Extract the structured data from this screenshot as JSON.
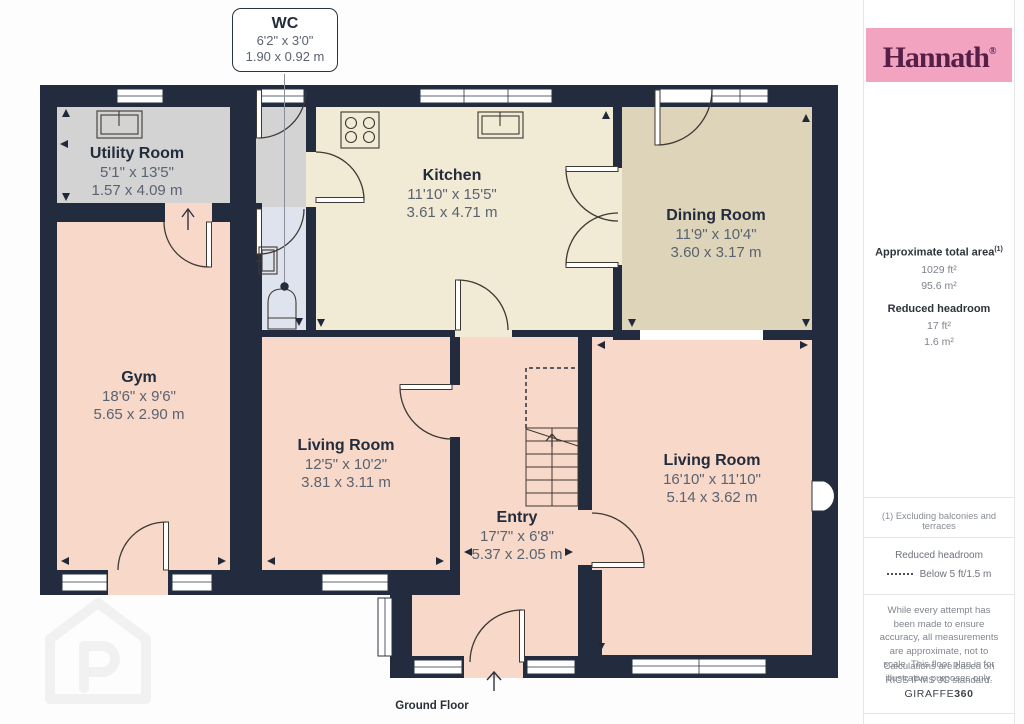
{
  "callout": {
    "title": "WC",
    "imperial": "6'2\" x 3'0\"",
    "metric": "1.90 x 0.92 m"
  },
  "rooms": [
    {
      "name": "Utility Room",
      "imperial": "5'1\" x 13'5\"",
      "metric": "1.57 x 4.09 m"
    },
    {
      "name": "Kitchen",
      "imperial": "11'10\" x 15'5\"",
      "metric": "3.61 x 4.71 m"
    },
    {
      "name": "Dining Room",
      "imperial": "11'9\" x 10'4\"",
      "metric": "3.60 x 3.17 m"
    },
    {
      "name": "Gym",
      "imperial": "18'6\" x 9'6\"",
      "metric": "5.65 x 2.90 m"
    },
    {
      "name": "Living Room",
      "imperial": "12'5\" x 10'2\"",
      "metric": "3.81 x 3.11 m"
    },
    {
      "name": "Entry",
      "imperial": "17'7\" x 6'8\"",
      "metric": "5.37 x 2.05 m"
    },
    {
      "name": "Living Room",
      "imperial": "16'10\" x 11'10\"",
      "metric": "5.14 x 3.62 m"
    }
  ],
  "floor_label": "Ground Floor",
  "sidebar": {
    "brand": "Hannath",
    "brand_reg": "®",
    "area_title": "Approximate total area",
    "area_sup": "(1)",
    "area_ft": "1029 ft²",
    "area_m": "95.6 m²",
    "headroom_title": "Reduced headroom",
    "headroom_ft": "17 ft²",
    "headroom_m": "1.6 m²",
    "footnote": "(1) Excluding balconies and terraces",
    "legend_title": "Reduced headroom",
    "legend_value": "Below 5 ft/1.5 m",
    "disclaimer1": "While every attempt has been made to ensure accuracy, all measurements are approximate, not to scale. This floor plan is for illustrative purposes only.",
    "disclaimer2": "Calculations are based on RICS IPMS 3C standard.",
    "brand2_normal": "GIRAFFE",
    "brand2_bold": "360"
  },
  "colors": {
    "wall": "#232c3e",
    "floor_salmon": "#f7d8c9",
    "floor_cream": "#f1ead5",
    "floor_tan": "#ddd4ba",
    "floor_gray": "#d3d3d4",
    "floor_wc_blue": "#dfe3ee",
    "brand_pink": "#f2a3c0",
    "brand_plum": "#551f47"
  }
}
